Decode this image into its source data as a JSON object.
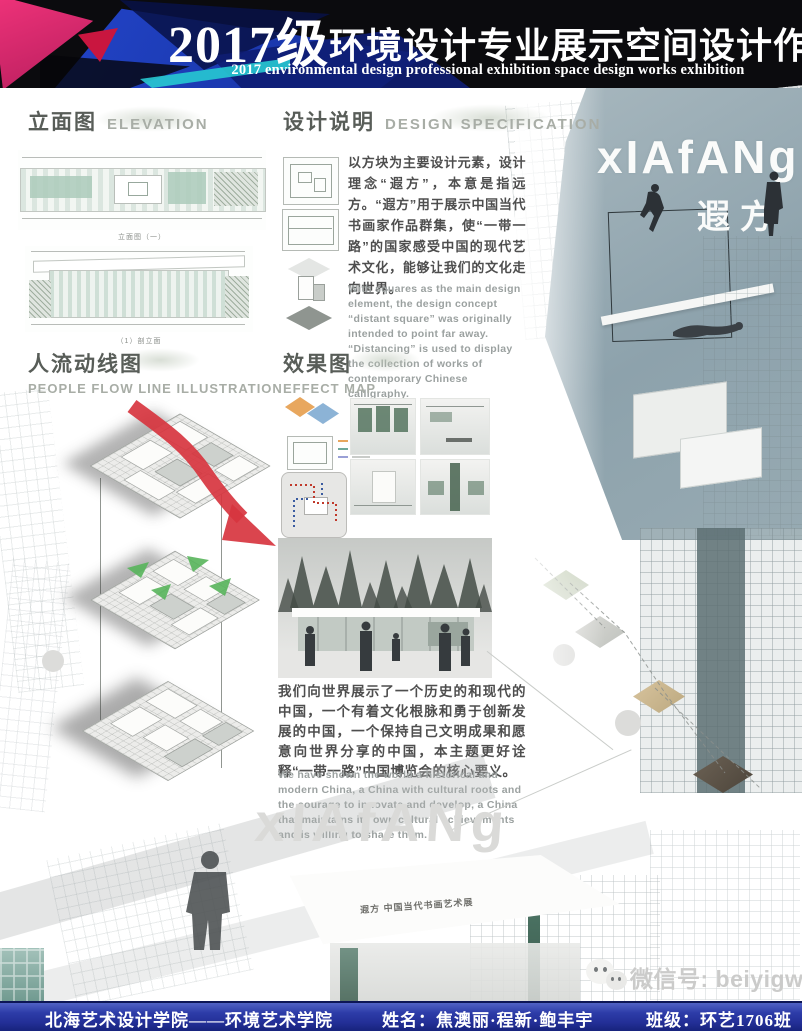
{
  "header": {
    "title_year": "2017级",
    "title_cn": "环境设计专业展示空间设计作品展",
    "title_en": "2017 environmental design professional exhibition space design works exhibition"
  },
  "sections": {
    "elevation": {
      "title_cn": "立面图",
      "title_en": "ELEVATION",
      "caption_1": "立面图（一）",
      "caption_2": "（1）剖立面"
    },
    "design_spec": {
      "title_cn": "设计说明",
      "title_en": "DESIGN SPECIFICATION",
      "paragraph_cn": "以方块为主要设计元素，设计理念“遐方”，本意是指远方。“遐方”用于展示中国当代书画家作品群集，使“一带一路”的国家感受中国的现代艺术文化，能够让我们的文化走向世界。",
      "paragraph_en": "With squares as the main design element, the design concept “distant square” was originally intended to point far away. “Distancing” is used to display the collection of works of contemporary Chinese calligraphy."
    },
    "flow": {
      "title_cn": "人流动线图",
      "title_en": "PEOPLE FLOW LINE ILLUSTRATION"
    },
    "effect": {
      "title_cn": "效果图",
      "title_en": "EFFECT MAP",
      "paragraph_cn": "我们向世界展示了一个历史的和现代的中国，一个有着文化根脉和勇于创新发展的中国，一个保持自己文明成果和愿意向世界分享的中国，本主题更好诠释“一带一路”中国博览会的核心要义。",
      "paragraph_en": "We have shown the world a historical and modern China, a China with cultural roots and the courage to innovate and develop, a China that maintains its own cultural achievements and is willing to share them."
    }
  },
  "brand": {
    "logo_en": "xIAfANg",
    "logo_cn": "遐方",
    "watermark": "xIAfANg",
    "sign_text": "遐方 中国当代书画艺术展"
  },
  "wechat": {
    "label": "微信号: beiyigw"
  },
  "footer": {
    "school": "北海艺术设计学院——环境艺术学院",
    "names": "姓名：焦澳丽·程新·鲍丰宇",
    "class_name": "班级：环艺1706班"
  },
  "colors": {
    "accent_blue": "#1d3fba",
    "accent_navy": "#0c2066",
    "accent_magenta": "#e6256e",
    "accent_cyan": "#27c9d2",
    "footer_blue": "#2b3aa6",
    "render_slate": "#93a7b0",
    "drawing_teal": "#abcabb",
    "arrow_red": "#d7353f",
    "arrow_green": "#58b55c"
  }
}
